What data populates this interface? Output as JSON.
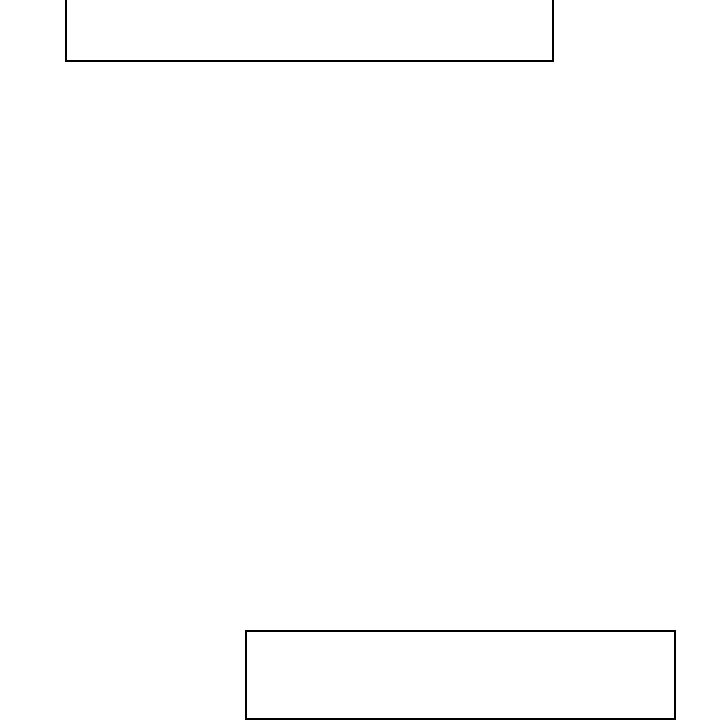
{
  "canvas": {
    "background": "#ffffff"
  },
  "colors": {
    "background": "#ffffff",
    "box_border": "#000000"
  },
  "boxes": [
    {
      "name": "top-box-outline",
      "label": "",
      "note_visible_text": ""
    },
    {
      "name": "bottom-box-outline",
      "label": "",
      "note_visible_text": ""
    }
  ]
}
